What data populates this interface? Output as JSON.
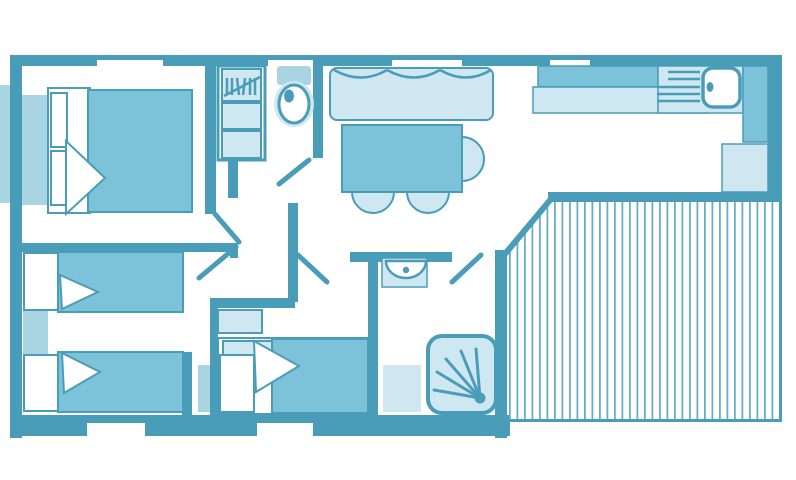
{
  "canvas": {
    "width": 796,
    "height": 480
  },
  "palette": {
    "wall": "#4a9db8",
    "medium": "#7cc2d8",
    "light": "#cfe7f1",
    "muted": "#a9d5e3",
    "stripe": "#67aec6",
    "floor": "#ffffff"
  },
  "floorplan": {
    "type": "mobile-home-floor-plan",
    "rooms": [
      {
        "name": "master-bedroom",
        "furniture": [
          "double-bed",
          "wardrobe"
        ]
      },
      {
        "name": "twin-bedroom",
        "furniture": [
          "single-bed",
          "single-bed",
          "bedside-shelf"
        ]
      },
      {
        "name": "third-bedroom",
        "furniture": [
          "bed",
          "shelf"
        ]
      },
      {
        "name": "wc",
        "furniture": [
          "toilet"
        ]
      },
      {
        "name": "shower-room",
        "furniture": [
          "washbasin",
          "shower-tray",
          "cabinet"
        ]
      },
      {
        "name": "living-dining",
        "furniture": [
          "sofa",
          "dining-table",
          "chairs"
        ]
      },
      {
        "name": "kitchen",
        "furniture": [
          "counter",
          "sink",
          "drainer",
          "cabinets"
        ]
      },
      {
        "name": "terrace",
        "furniture": [
          "decking"
        ]
      }
    ],
    "deck": {
      "stripe_spacing": 7.5,
      "stripe_width": 1.8
    }
  }
}
